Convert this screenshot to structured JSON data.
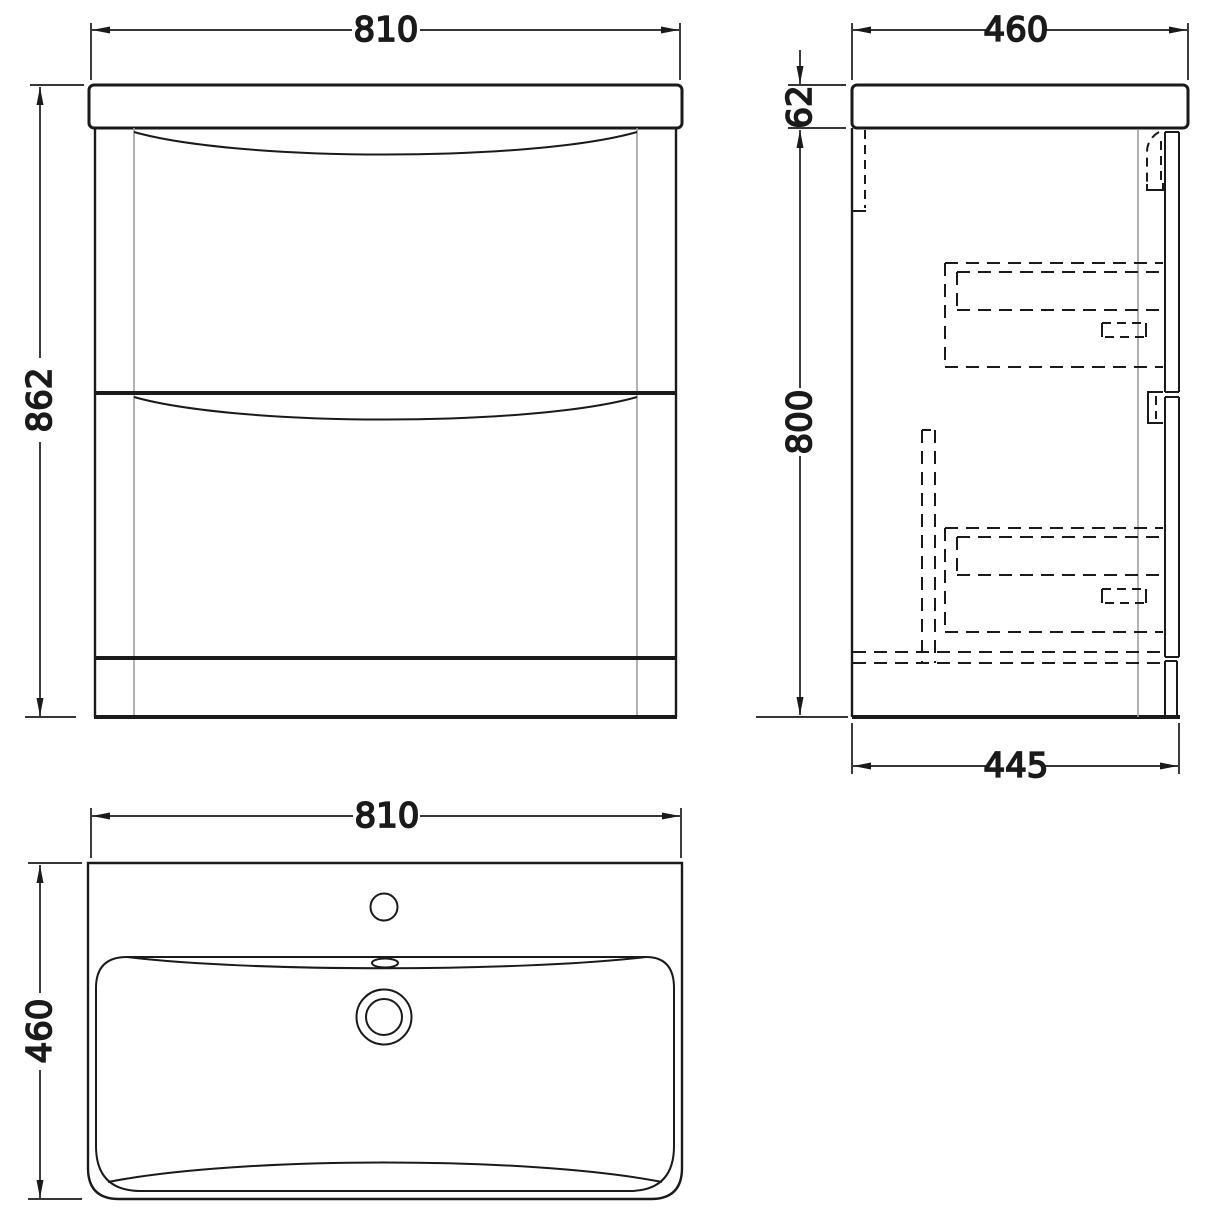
{
  "drawing": {
    "type": "technical-drawing",
    "subject": "vanity-unit-with-basin",
    "colors": {
      "line": "#1a1a1a",
      "thin_line": "#9e9e9e",
      "background": "#ffffff"
    },
    "front_view": {
      "width": "810",
      "height": "862"
    },
    "side_view": {
      "top_width": "460",
      "worktop_thickness": "62",
      "cabinet_height": "800",
      "base_depth": "445"
    },
    "plan_view": {
      "width": "810",
      "depth": "460"
    }
  }
}
